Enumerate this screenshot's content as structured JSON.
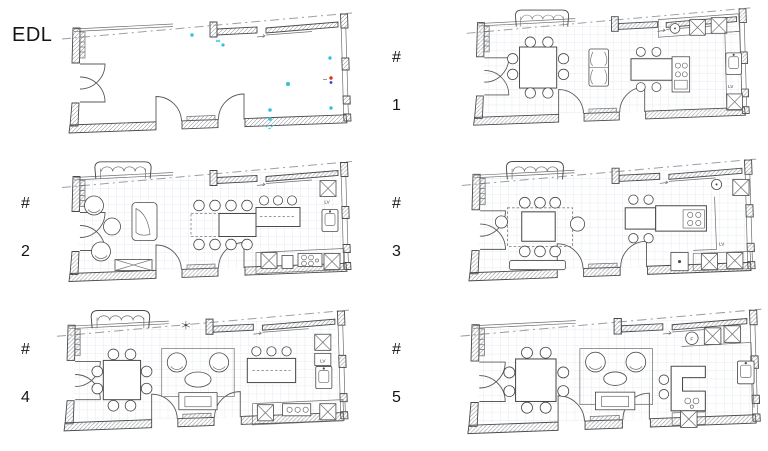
{
  "sheet": {
    "background": "#ffffff"
  },
  "labels": {
    "hash": "#",
    "dishwasher": "LV",
    "oven": "F"
  },
  "plans": [
    {
      "key": "edl",
      "label": "EDL",
      "kind": "existing empty plan",
      "annotation_colors": {
        "cyan": "#35bfdd",
        "red": "#d93425",
        "blue": "#2b3fd0"
      }
    },
    {
      "key": "option-1",
      "number": "1",
      "kind": "furnished option"
    },
    {
      "key": "option-2",
      "number": "2",
      "kind": "furnished option"
    },
    {
      "key": "option-3",
      "number": "3",
      "kind": "furnished option"
    },
    {
      "key": "option-4",
      "number": "4",
      "kind": "furnished option"
    },
    {
      "key": "option-5",
      "number": "5",
      "kind": "furnished option"
    }
  ],
  "drawing_colors": {
    "ink": "#4a4a4a",
    "grid": "#dde3ea",
    "hatch": "#989da3",
    "dashdot": "#9aa0a6"
  }
}
